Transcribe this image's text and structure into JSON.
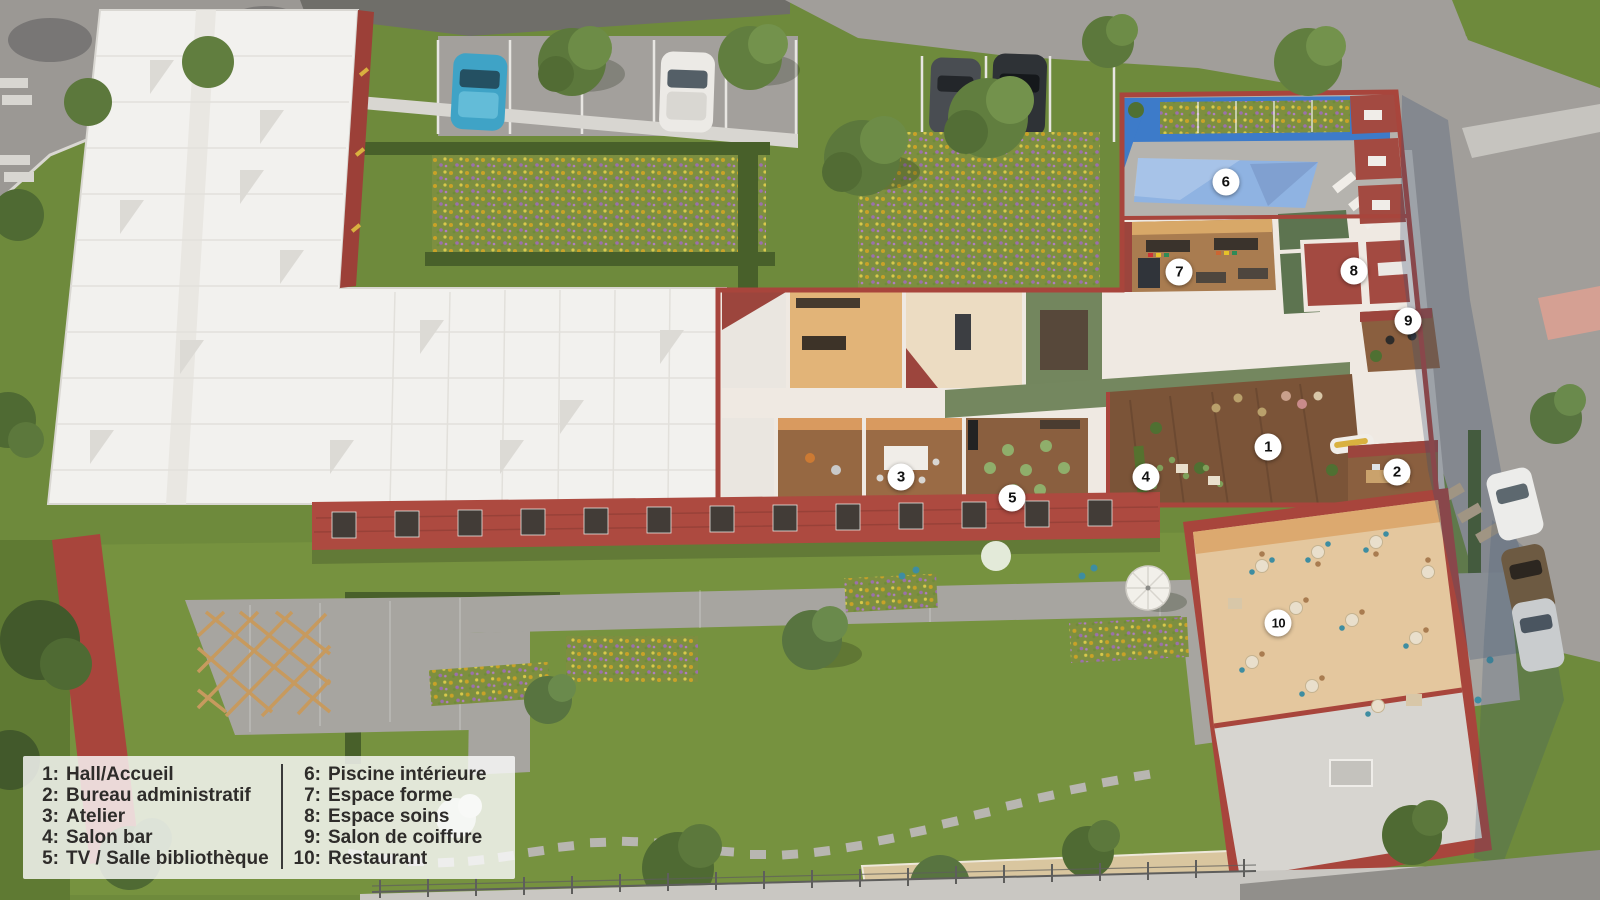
{
  "legend": {
    "left_column": [
      {
        "num": "1:",
        "label": "Hall/Accueil"
      },
      {
        "num": "2:",
        "label": "Bureau administratif"
      },
      {
        "num": "3:",
        "label": "Atelier"
      },
      {
        "num": "4:",
        "label": "Salon bar"
      },
      {
        "num": "5:",
        "label": "TV / Salle bibliothèque"
      }
    ],
    "right_column": [
      {
        "num": "6:",
        "label": "Piscine intérieure"
      },
      {
        "num": "7:",
        "label": "Espace forme"
      },
      {
        "num": "8:",
        "label": "Espace soins"
      },
      {
        "num": "9:",
        "label": "Salon de coiffure"
      },
      {
        "num": "10:",
        "label": "Restaurant"
      }
    ]
  },
  "markers": [
    {
      "num": "1",
      "x_pct": 79.25,
      "y_pct": 49.7
    },
    {
      "num": "2",
      "x_pct": 87.3,
      "y_pct": 52.4
    },
    {
      "num": "3",
      "x_pct": 56.3,
      "y_pct": 53.0
    },
    {
      "num": "4",
      "x_pct": 71.6,
      "y_pct": 53.0
    },
    {
      "num": "5",
      "x_pct": 63.25,
      "y_pct": 55.3
    },
    {
      "num": "6",
      "x_pct": 76.6,
      "y_pct": 20.2
    },
    {
      "num": "7",
      "x_pct": 73.7,
      "y_pct": 30.2
    },
    {
      "num": "8",
      "x_pct": 84.6,
      "y_pct": 30.1
    },
    {
      "num": "9",
      "x_pct": 88.0,
      "y_pct": 35.7
    },
    {
      "num": "10",
      "x_pct": 79.9,
      "y_pct": 69.2
    }
  ],
  "colors": {
    "marker_bg": "#ffffff",
    "marker_text": "#111111",
    "legend_bg": "rgba(250,250,250,0.82)",
    "legend_text": "#2e2c2a",
    "grass": "#6e8a3c",
    "road_gray": "#a19e9a",
    "building_red": "#a8453c",
    "white_roof": "#f2f1ee",
    "pool_water": "#8fb3e2",
    "pool_wall_blue": "#3d7bc9",
    "wood_floor": "#7b5438",
    "terrace_floor": "#e4c79e"
  }
}
